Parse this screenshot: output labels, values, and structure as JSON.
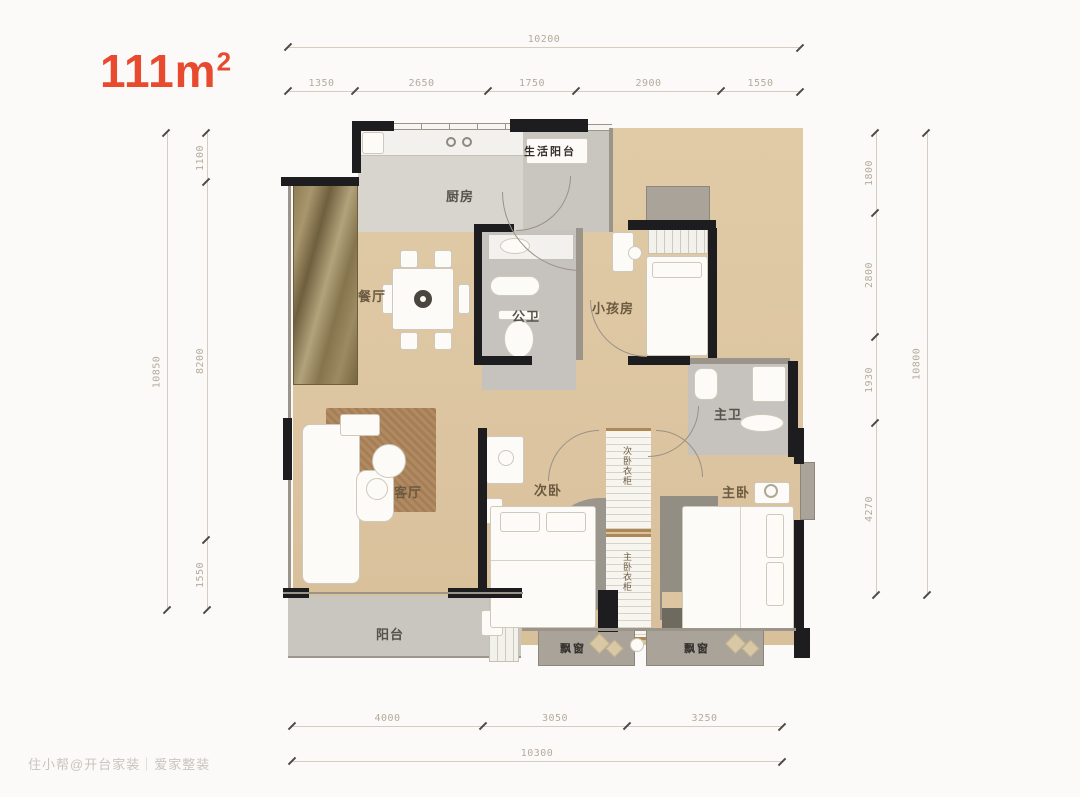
{
  "title": {
    "area": "111m",
    "sup": "2"
  },
  "dimensions": {
    "top": {
      "total": "10200",
      "segments": [
        "1350",
        "2650",
        "1750",
        "2900",
        "1550"
      ]
    },
    "left": {
      "total": "10850",
      "segments": [
        "1100",
        "8200",
        "1550"
      ]
    },
    "right": {
      "total": "10800",
      "segments": [
        "1800",
        "2800",
        "1930",
        "4270"
      ]
    },
    "bottom": {
      "total": "10300",
      "segments": [
        "4000",
        "3050",
        "3250"
      ]
    }
  },
  "rooms": {
    "service_balcony": "生活阳台",
    "kitchen": "厨房",
    "dining": "餐厅",
    "public_bath": "公卫",
    "kids_room": "小孩房",
    "master_bath": "主卫",
    "living": "客厅",
    "second_bedroom": "次卧",
    "second_wardrobe": "次卧衣柜",
    "master_wardrobe": "主卧衣柜",
    "master_bedroom": "主卧",
    "balcony": "阳台",
    "bay_window_left": "飘窗",
    "bay_window_right": "飘窗"
  },
  "watermark": "住小帮@开台家装｜爱家整装",
  "colors": {
    "accent_red": "#e84a2f",
    "wall_black": "#1d1d1f",
    "wood_floor": "#dcc5a0",
    "gray_floor": "#c9c6bf",
    "dimension_text": "#b6aa9c"
  }
}
